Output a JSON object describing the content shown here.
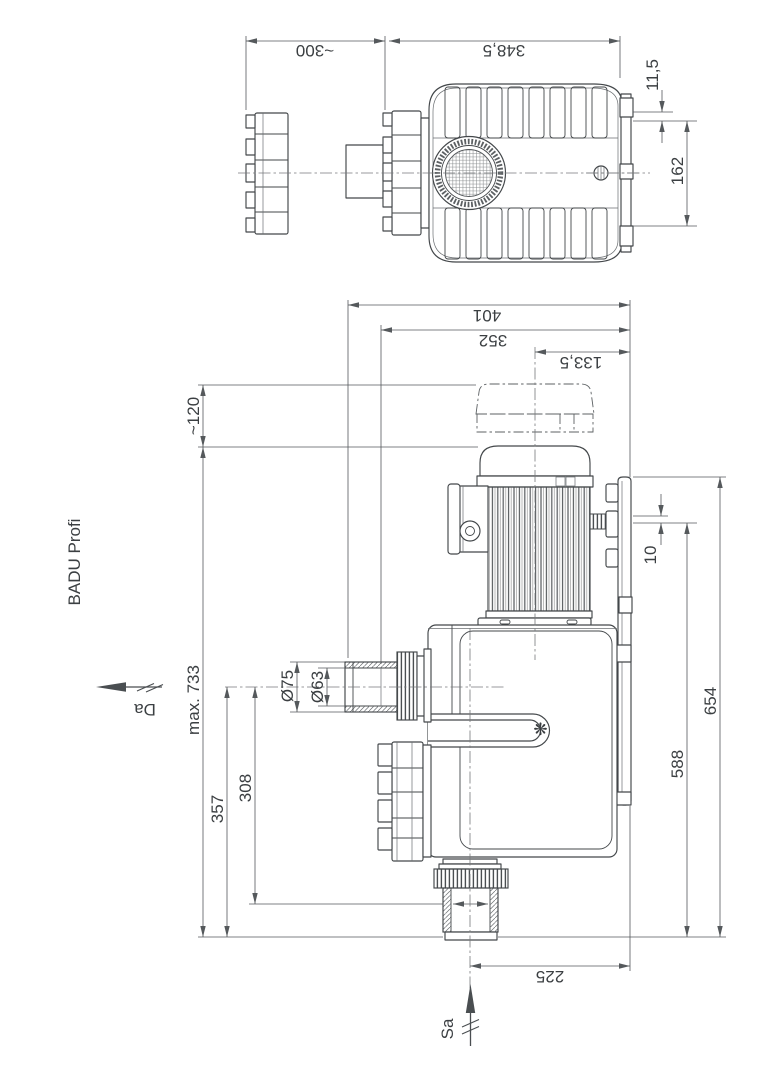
{
  "title": "BADU Profi",
  "icons": {
    "badu_logo": "❋"
  },
  "dims": {
    "top": {
      "clearance": "~300",
      "length": "348,5",
      "slot_width": "11,5",
      "slot_spacing": "162"
    },
    "front": {
      "overall_width": "401",
      "width_to_union": "352",
      "center_to_plate": "133,5",
      "fan_removal_clearance": "~120",
      "plate_offset": "10",
      "total_height": "654",
      "drain_height": "588",
      "max_height": "max. 733",
      "discharge_height": "357",
      "socket_height": "308",
      "discharge_outer_dia": "Ø75",
      "discharge_inner_dia": "Ø63",
      "suction_to_plate": "225"
    }
  },
  "flow": {
    "discharge": "Da",
    "suction": "Sa"
  }
}
